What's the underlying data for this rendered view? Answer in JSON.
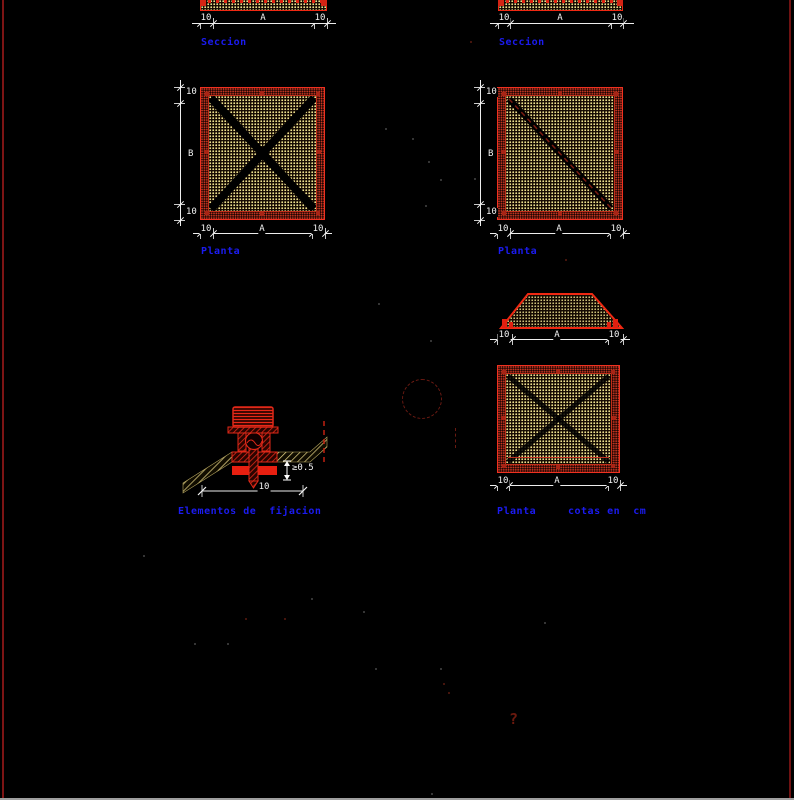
{
  "labels": {
    "seccion": "Seccion",
    "planta": "Planta",
    "cotas": "cotas en  cm",
    "elementos": "Elementos de  fijacion"
  },
  "dims": {
    "ten": "10",
    "a": "A",
    "b": "B",
    "min_thickness": "≥0.5"
  },
  "stray": {
    "question_mark": "?"
  },
  "colors": {
    "red": "#e8281a",
    "hatch_yellow": "#ece08e",
    "label_blue": "#1b1bf0",
    "dim_white": "#f2f2f2"
  }
}
